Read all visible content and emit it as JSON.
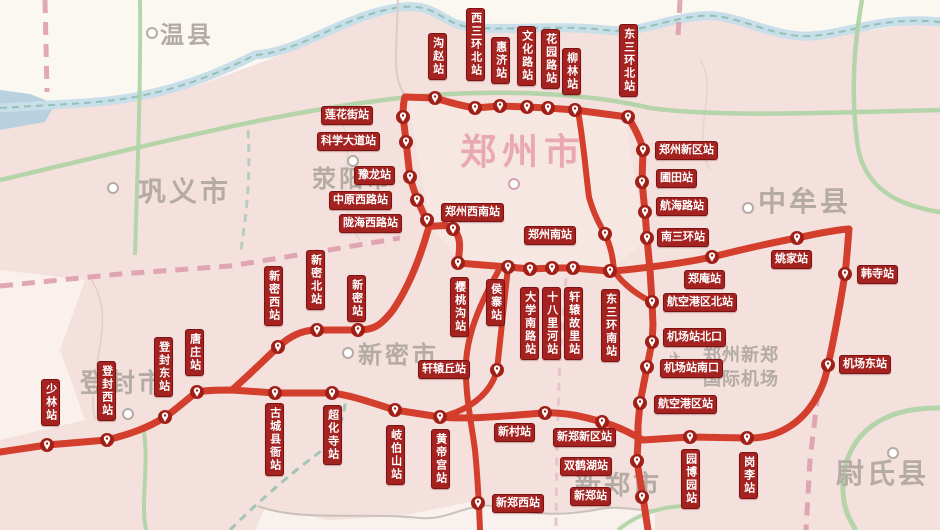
{
  "map": {
    "colors": {
      "land": "#f4e0dd",
      "line_red": "#d43e2c",
      "marker_red": "#a02018",
      "station_label_bg": "#a42220",
      "city_grey": "#b4aba5",
      "city_pink": "#e9a8b4",
      "road_green": "#aed3a4",
      "river_blue": "#c8dee9",
      "boundary_pink": "#dc9aab"
    },
    "regions": [
      {
        "name": "温县",
        "x": 160,
        "y": 24,
        "size": 24,
        "style": "grey",
        "dot": [
          151,
          32
        ]
      },
      {
        "name": "巩义市",
        "x": 138,
        "y": 178,
        "size": 28,
        "style": "grey",
        "dot": [
          112,
          187
        ]
      },
      {
        "name": "荥阳市",
        "x": 312,
        "y": 168,
        "size": 24,
        "style": "grey",
        "dot": [
          352,
          160
        ]
      },
      {
        "name": "郑州市",
        "x": 460,
        "y": 134,
        "size": 36,
        "style": "pink",
        "dot": [
          513,
          183
        ]
      },
      {
        "name": "中牟县",
        "x": 758,
        "y": 188,
        "size": 28,
        "style": "grey",
        "dot": [
          747,
          207
        ]
      },
      {
        "name": "新密市",
        "x": 358,
        "y": 344,
        "size": 24,
        "style": "grey",
        "dot": [
          347,
          352
        ]
      },
      {
        "name": "登封市",
        "x": 80,
        "y": 370,
        "size": 26,
        "style": "grey",
        "dot": [
          127,
          413
        ]
      },
      {
        "name": "新郑市",
        "x": 575,
        "y": 472,
        "size": 26,
        "style": "grey",
        "dot": null
      },
      {
        "name": "尉氏县",
        "x": 836,
        "y": 460,
        "size": 28,
        "style": "grey",
        "dot": [
          892,
          452
        ]
      },
      {
        "name": "郑州新郑",
        "x": 703,
        "y": 346,
        "size": 18,
        "style": "grey-sm",
        "dot": null
      },
      {
        "name": "国际机场",
        "x": 703,
        "y": 370,
        "size": 18,
        "style": "grey-sm",
        "dot": null
      }
    ],
    "airport_icon": {
      "glyph": "✈",
      "x": 669,
      "y": 348
    },
    "lines": [
      {
        "name": "city-loop-line",
        "w": 7,
        "d": "M428,226 L427,220 C422,212 414,192 410,177 C408,160 405,130 403,117 C403,108 404,100 405,97 L435,98 C448,102 462,106 475,108 L500,106 L527,107 L548,108 L575,110 L628,117 C636,130 641,140 643,150 L642,182 L645,212 L647,238 L650,270 L652,302 L653,325 L652,342 L647,367 L640,403 L638,425 L638,440 L637,461 L640,480 L643,497 L648,530"
      },
      {
        "name": "southwest-connector",
        "w": 7,
        "d": "M428,226 C438,227 447,223 453,229 C463,238 459,252 458,263"
      },
      {
        "name": "xinmi-branch",
        "w": 7,
        "d": "M428,230 C420,258 408,288 393,310 C380,327 372,330 358,330 L317,330 C302,330 290,336 278,347 C262,362 246,378 232,390"
      },
      {
        "name": "south-outer-loop-line",
        "w": 7,
        "d": "M0,452 L47,445 L107,440 C130,434 148,428 165,417 C178,408 186,400 197,392 C208,390 220,390 232,390 L275,393 L332,393 C355,396 375,404 395,410 L440,417 C475,420 510,415 545,413 C565,412 585,417 602,422 C620,427 632,434 643,440 L690,437 L747,438 C775,439 800,425 815,400 C824,385 826,375 828,365 C835,335 840,305 845,274 C847,258 848,240 849,229 C835,230 815,234 797,238 C770,243 740,250 712,257 C680,264 645,268 614,271 L608,271 L573,268 L552,268 L530,269 L508,267 L458,263"
      },
      {
        "name": "airport-express-line",
        "w": 6,
        "d": "M578,111 C584,145 586,175 589,197 C594,215 600,225 605,234 C611,247 613,258 614,271 C622,283 637,295 652,302"
      },
      {
        "name": "xuanyuanqiu-link",
        "w": 6,
        "d": "M508,267 C504,305 500,340 497,370 C490,397 465,410 448,415"
      },
      {
        "name": "xinzhengxi-link",
        "w": 6,
        "d": "M500,268 C482,300 468,330 466,362 C465,395 471,420 475,450 C478,480 479,505 480,530"
      }
    ],
    "stations": [
      {
        "name": "沟赵站",
        "dir": "v",
        "x": 428,
        "y": 33,
        "m": [
          435,
          98
        ]
      },
      {
        "name": "西三环北站",
        "dir": "v",
        "x": 466,
        "y": 8,
        "m": [
          475,
          108
        ]
      },
      {
        "name": "惠济站",
        "dir": "v",
        "x": 491,
        "y": 37,
        "m": [
          500,
          106
        ]
      },
      {
        "name": "文化路站",
        "dir": "v",
        "x": 517,
        "y": 26,
        "m": [
          527,
          107
        ]
      },
      {
        "name": "花园路站",
        "dir": "v",
        "x": 541,
        "y": 29,
        "m": [
          548,
          108
        ]
      },
      {
        "name": "柳林站",
        "dir": "v",
        "x": 562,
        "y": 48,
        "m": [
          575,
          110
        ]
      },
      {
        "name": "东三环北站",
        "dir": "v",
        "x": 619,
        "y": 24,
        "m": [
          628,
          117
        ]
      },
      {
        "name": "莲花街站",
        "dir": "h",
        "x": 321,
        "y": 106,
        "m": [
          403,
          117
        ]
      },
      {
        "name": "科学大道站",
        "dir": "h",
        "x": 317,
        "y": 132,
        "m": [
          406,
          142
        ]
      },
      {
        "name": "豫龙站",
        "dir": "h",
        "x": 354,
        "y": 166,
        "m": [
          410,
          177
        ]
      },
      {
        "name": "中原西路站",
        "dir": "h",
        "x": 329,
        "y": 191,
        "m": [
          417,
          200
        ]
      },
      {
        "name": "陇海西路站",
        "dir": "h",
        "x": 339,
        "y": 214,
        "m": [
          427,
          220
        ]
      },
      {
        "name": "郑州西南站",
        "dir": "h",
        "x": 441,
        "y": 203,
        "m": [
          453,
          229
        ]
      },
      {
        "name": "郑州新区站",
        "dir": "h",
        "x": 655,
        "y": 141,
        "m": [
          643,
          150
        ]
      },
      {
        "name": "圃田站",
        "dir": "h",
        "x": 656,
        "y": 169,
        "m": [
          642,
          182
        ]
      },
      {
        "name": "航海路站",
        "dir": "h",
        "x": 656,
        "y": 197,
        "m": [
          645,
          212
        ]
      },
      {
        "name": "南三环站",
        "dir": "h",
        "x": 657,
        "y": 228,
        "m": [
          647,
          238
        ]
      },
      {
        "name": "郑州南站",
        "dir": "h",
        "x": 524,
        "y": 226,
        "m": [
          605,
          234
        ]
      },
      {
        "name": "郑庵站",
        "dir": "h",
        "x": 684,
        "y": 270,
        "m": [
          712,
          257
        ]
      },
      {
        "name": "姚家站",
        "dir": "h",
        "x": 771,
        "y": 250,
        "m": [
          797,
          238
        ]
      },
      {
        "name": "韩寺站",
        "dir": "h",
        "x": 857,
        "y": 265,
        "m": [
          845,
          274
        ]
      },
      {
        "name": "航空港区北站",
        "dir": "h",
        "x": 663,
        "y": 293,
        "m": [
          652,
          302
        ]
      },
      {
        "name": "机场站北口",
        "dir": "h",
        "x": 663,
        "y": 328,
        "m": [
          652,
          342
        ]
      },
      {
        "name": "机场站南口",
        "dir": "h",
        "x": 660,
        "y": 359,
        "m": [
          647,
          367
        ]
      },
      {
        "name": "机场东站",
        "dir": "h",
        "x": 839,
        "y": 355,
        "m": [
          828,
          365
        ]
      },
      {
        "name": "航空港区站",
        "dir": "h",
        "x": 654,
        "y": 395,
        "m": [
          640,
          403
        ]
      },
      {
        "name": "新郑新区站",
        "dir": "h",
        "x": 553,
        "y": 428,
        "m": [
          602,
          422
        ]
      },
      {
        "name": "双鹤湖站",
        "dir": "h",
        "x": 560,
        "y": 457,
        "m": [
          637,
          461
        ]
      },
      {
        "name": "新郑站",
        "dir": "h",
        "x": 570,
        "y": 487,
        "m": [
          642,
          497
        ]
      },
      {
        "name": "园博园站",
        "dir": "v",
        "x": 681,
        "y": 449,
        "m": [
          690,
          437
        ]
      },
      {
        "name": "岗李站",
        "dir": "v",
        "x": 739,
        "y": 452,
        "m": [
          747,
          438
        ]
      },
      {
        "name": "樱桃沟站",
        "dir": "v",
        "x": 450,
        "y": 277,
        "m": [
          458,
          263
        ]
      },
      {
        "name": "侯寨站",
        "dir": "v",
        "x": 486,
        "y": 279,
        "m": [
          508,
          267
        ]
      },
      {
        "name": "大学南路站",
        "dir": "v",
        "x": 520,
        "y": 287,
        "m": [
          530,
          269
        ]
      },
      {
        "name": "十八里河站",
        "dir": "v",
        "x": 542,
        "y": 287,
        "m": [
          552,
          268
        ]
      },
      {
        "name": "轩辕故里站",
        "dir": "v",
        "x": 564,
        "y": 287,
        "m": [
          573,
          268
        ]
      },
      {
        "name": "东三环南站",
        "dir": "v",
        "x": 601,
        "y": 289,
        "m": [
          610,
          271
        ]
      },
      {
        "name": "轩辕丘站",
        "dir": "h",
        "x": 418,
        "y": 360,
        "m": [
          497,
          370
        ]
      },
      {
        "name": "新村站",
        "dir": "h",
        "x": 494,
        "y": 423,
        "m": [
          545,
          413
        ]
      },
      {
        "name": "新郑西站",
        "dir": "h",
        "x": 492,
        "y": 494,
        "m": [
          478,
          503
        ]
      },
      {
        "name": "黄帝宫站",
        "dir": "v",
        "x": 431,
        "y": 429,
        "m": [
          440,
          417
        ]
      },
      {
        "name": "岐伯山站",
        "dir": "v",
        "x": 386,
        "y": 425,
        "m": [
          395,
          410
        ]
      },
      {
        "name": "超化寺站",
        "dir": "v",
        "x": 323,
        "y": 405,
        "m": [
          332,
          393
        ]
      },
      {
        "name": "古城县衙站",
        "dir": "v",
        "x": 265,
        "y": 403,
        "m": [
          275,
          393
        ]
      },
      {
        "name": "新密西站",
        "dir": "v",
        "x": 264,
        "y": 266,
        "m": [
          278,
          347
        ]
      },
      {
        "name": "新密北站",
        "dir": "v",
        "x": 306,
        "y": 250,
        "m": [
          317,
          330
        ]
      },
      {
        "name": "新密站",
        "dir": "v",
        "x": 347,
        "y": 275,
        "m": [
          358,
          330
        ]
      },
      {
        "name": "唐庄站",
        "dir": "v",
        "x": 185,
        "y": 329,
        "m": [
          197,
          392
        ]
      },
      {
        "name": "登封东站",
        "dir": "v",
        "x": 154,
        "y": 337,
        "m": [
          165,
          417
        ]
      },
      {
        "name": "登封西站",
        "dir": "v",
        "x": 97,
        "y": 361,
        "m": [
          107,
          440
        ]
      },
      {
        "name": "少林站",
        "dir": "v",
        "x": 41,
        "y": 379,
        "m": [
          47,
          445
        ]
      }
    ]
  }
}
